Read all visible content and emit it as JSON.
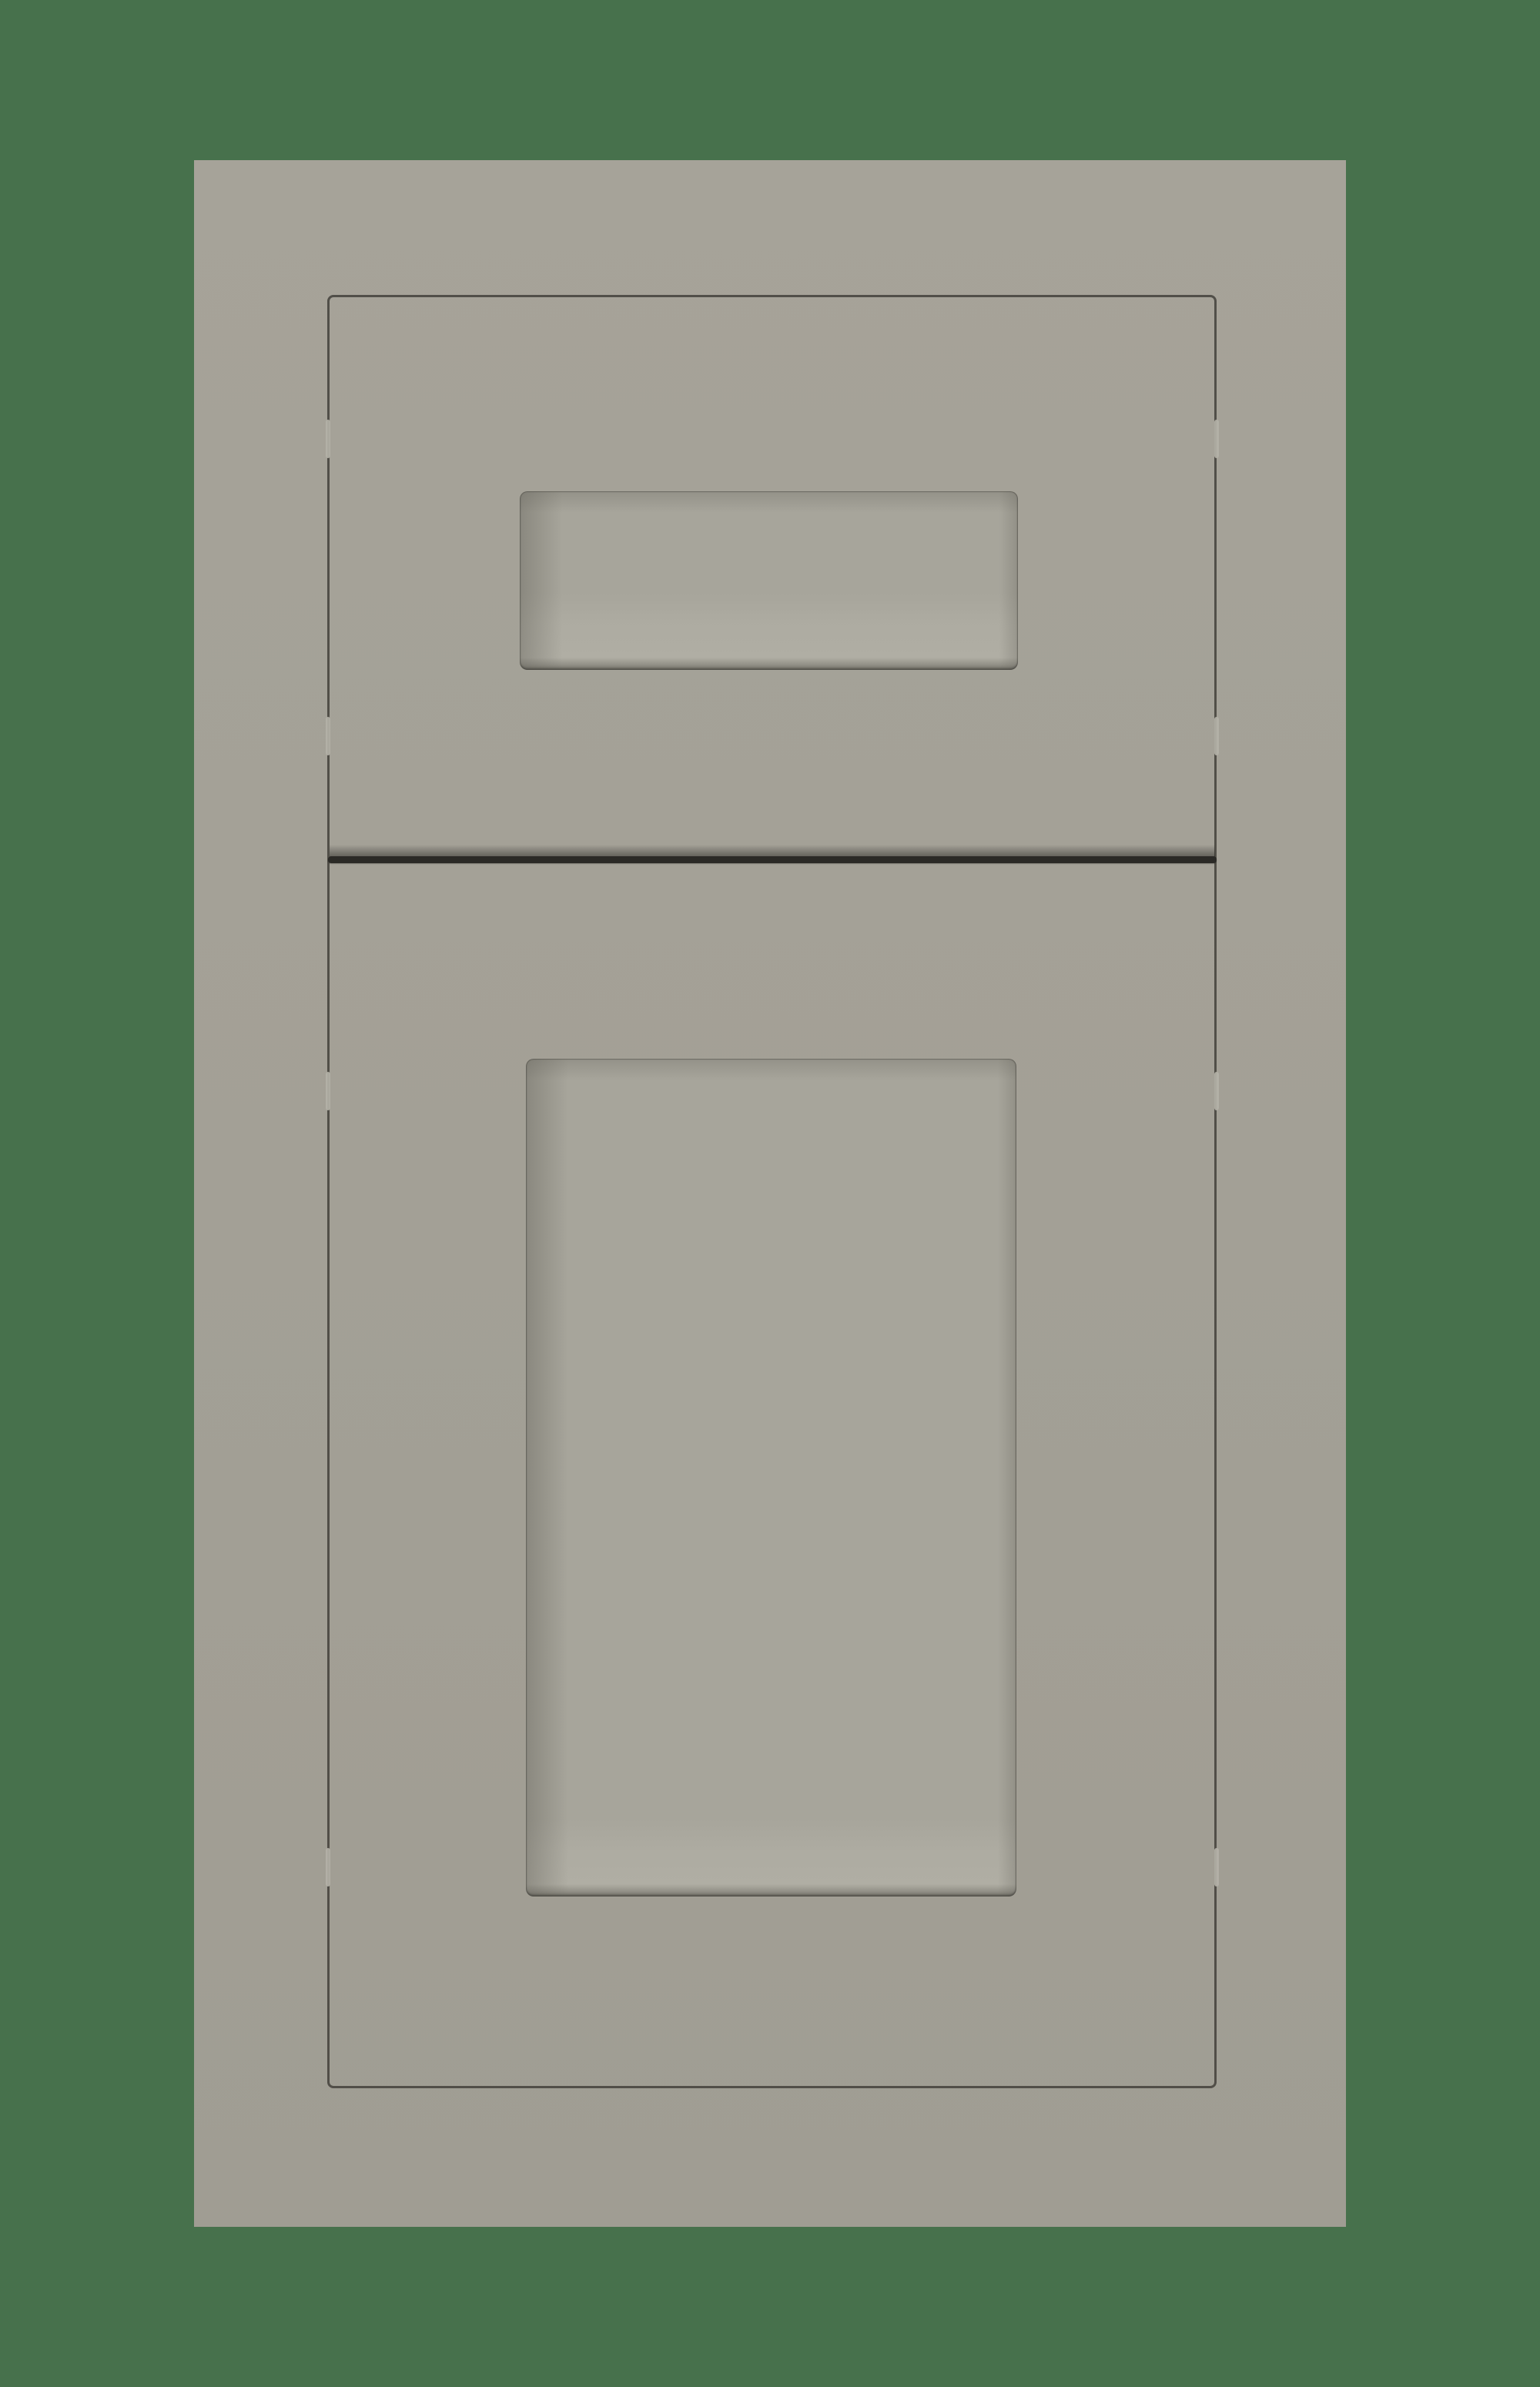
{
  "scene": {
    "subject": "cabinet-door-and-drawer-sample",
    "text_content": ""
  },
  "colors": {
    "bg-green": "#47714C",
    "slab-gray-top": "#A6A399",
    "slab-gray-bottom": "#A09D93",
    "panel-base": "#A7A59B",
    "outline-dark": "#45433D",
    "gap-dark": "#2B2A26",
    "notch-light": "#B3B1A7",
    "bevel-shadow": "#62605B",
    "bevel-highlight": "#B7B5AB"
  }
}
